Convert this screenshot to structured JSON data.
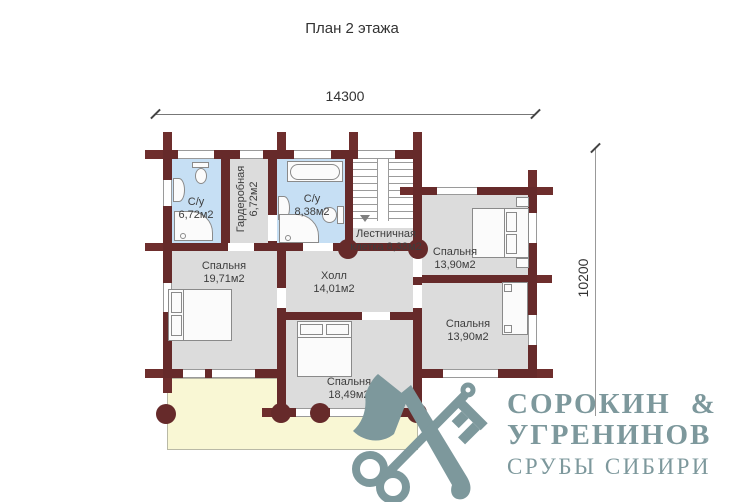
{
  "title": "План 2 этажа",
  "dimensions": {
    "top": "14300",
    "right": "10200"
  },
  "rooms": [
    {
      "name": "С/у",
      "area": "6,72м2"
    },
    {
      "name": "Гардеробная",
      "area": "6,72м2"
    },
    {
      "name": "С/у",
      "area": "8,38м2"
    },
    {
      "name": "Лестничная",
      "area": "клетка 8,38м2"
    },
    {
      "name": "Спальня",
      "area": "13,90м2"
    },
    {
      "name": "Спальня",
      "area": "19,71м2"
    },
    {
      "name": "Холл",
      "area": "14,01м2"
    },
    {
      "name": "Спальня",
      "area": "13,90м2"
    },
    {
      "name": "Спальня",
      "area": "18,49м2"
    }
  ],
  "logo": {
    "line1": "СОРОКИН",
    "amp": "&",
    "line2": "УГРЕНИНОВ",
    "line3": "СРУБЫ СИБИРИ"
  },
  "colors": {
    "wall": "#662a2a",
    "room": "#dcdcdc",
    "bathroom": "#c6dff4",
    "balcony": "#f9f7d4",
    "logo": "#7d989c"
  }
}
